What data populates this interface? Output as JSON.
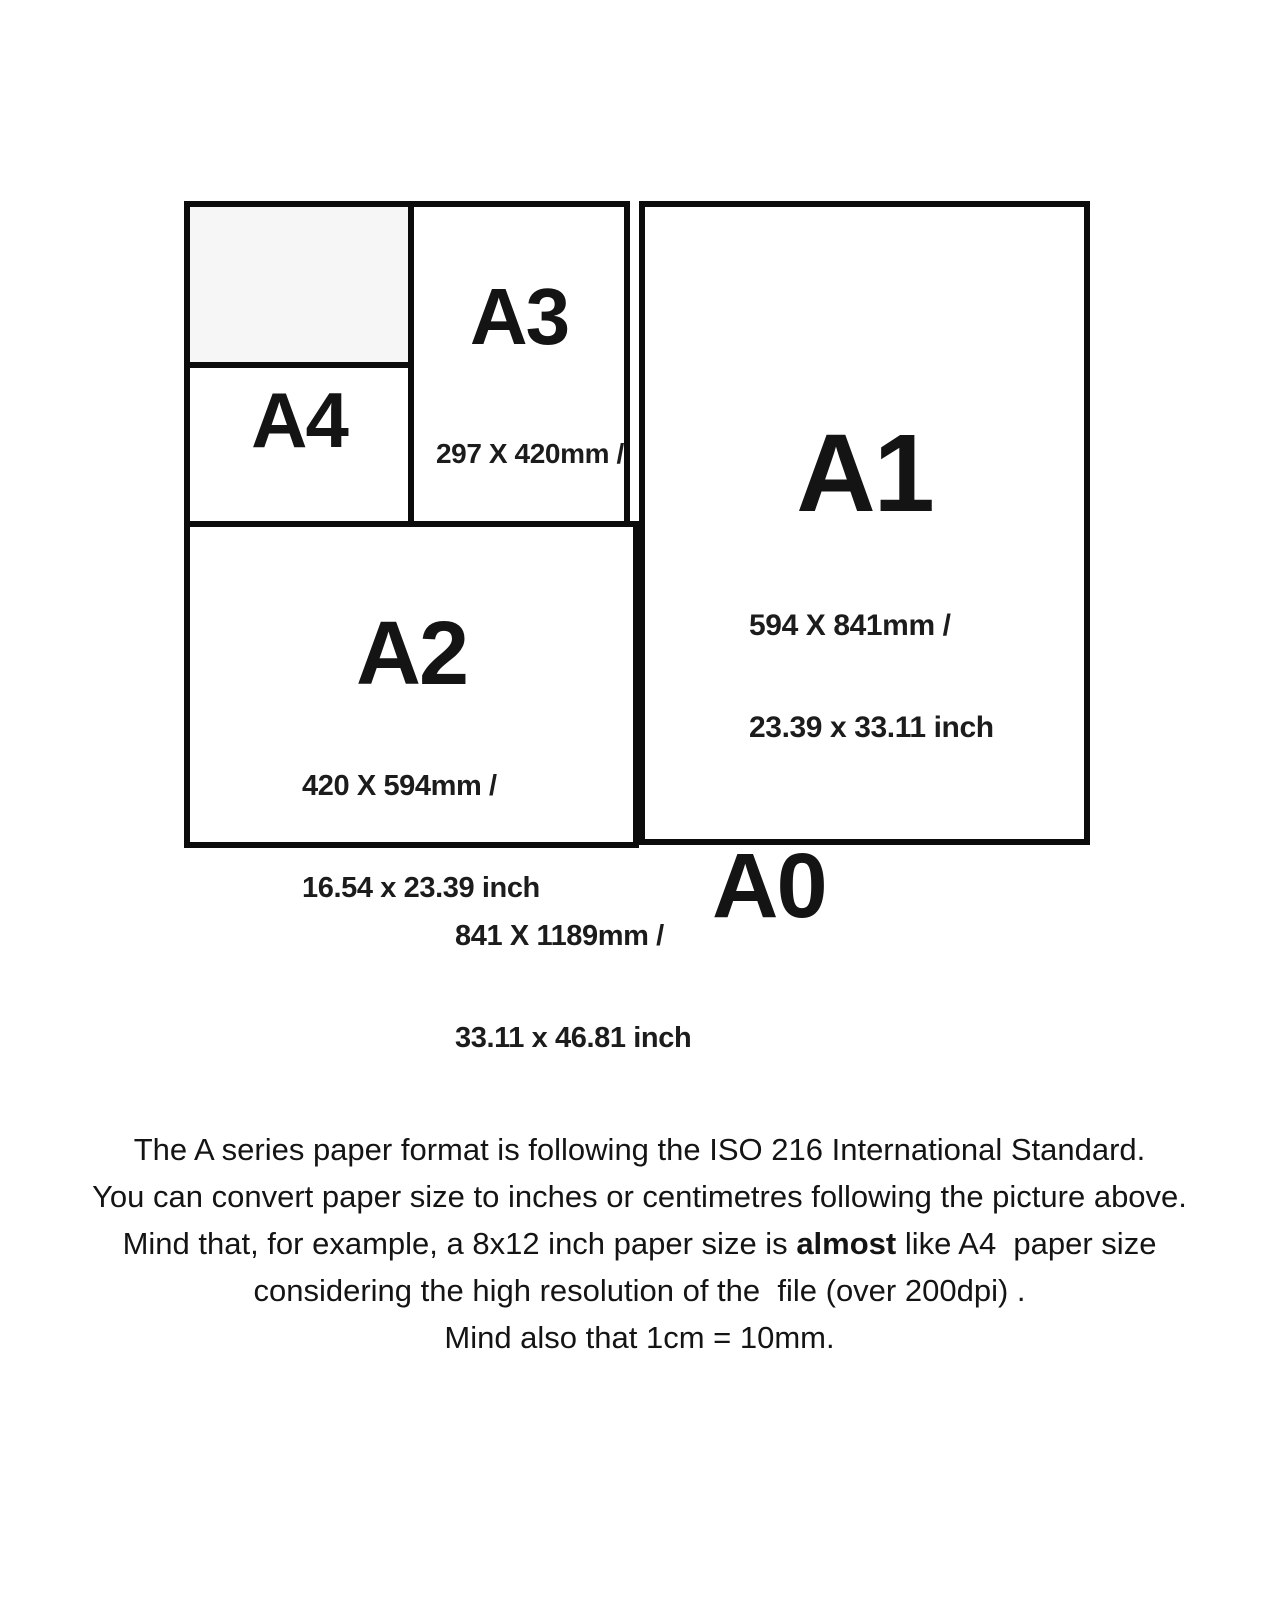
{
  "diagram": {
    "papers": [
      {
        "label": "A4",
        "mm": "210 X 297mm /",
        "inch": "8.27 x 11.69 inch"
      },
      {
        "label": "A3",
        "mm": "297 X 420mm /",
        "inch": "11.69 x 16.54 inch"
      },
      {
        "label": "A2",
        "mm": "420 X 594mm /",
        "inch": "16.54 x 23.39 inch"
      },
      {
        "label": "A1",
        "mm": "594 X 841mm /",
        "inch": "23.39 x 33.11 inch"
      },
      {
        "label": "A0",
        "mm": "841 X 1189mm /",
        "inch": "33.11 x 46.81 inch"
      }
    ],
    "colors": {
      "line": "#0c0c0c",
      "placeholder_fill": "#f6f6f6",
      "text": "#141414",
      "background": "#ffffff"
    }
  },
  "caption": {
    "line1": "The A series paper format is following the ISO 216 International Standard.",
    "line2": "You can convert paper size to inches or centimetres following the picture above.",
    "line3_before": "Mind that, for example, a 8x12 inch paper size is ",
    "line3_bold": "almost",
    "line3_after": " like A4  paper size",
    "line4": "considering the high resolution of the  file (over 200dpi) .",
    "line5": "Mind also that 1cm = 10mm."
  }
}
